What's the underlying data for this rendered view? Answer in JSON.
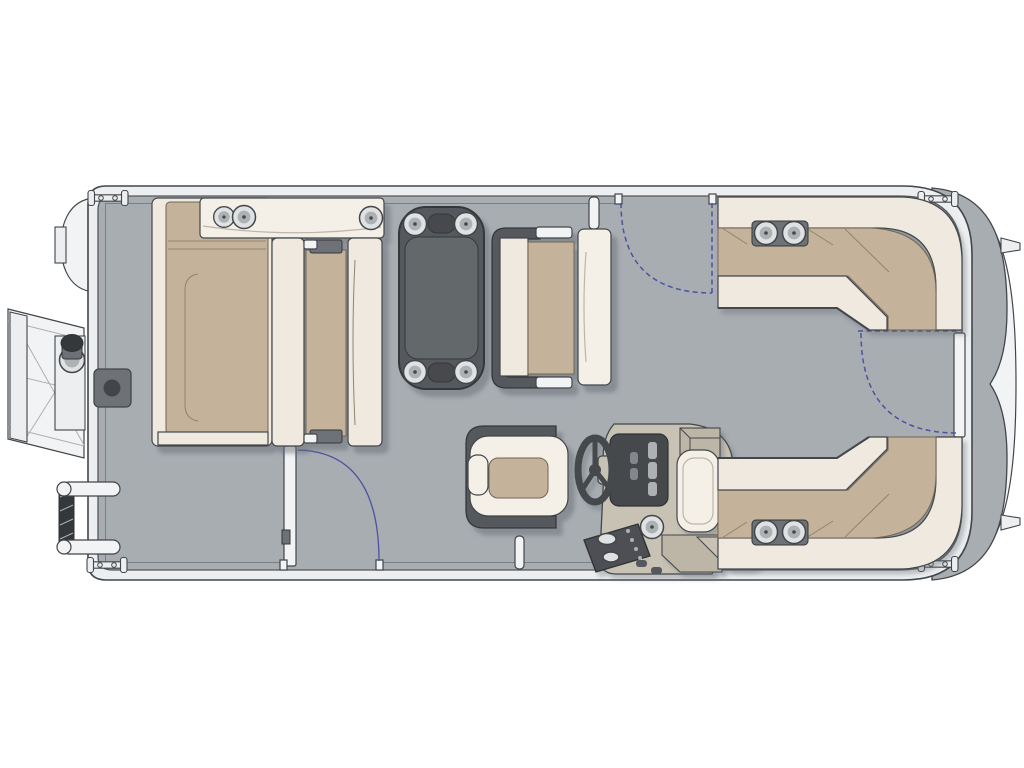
{
  "image": {
    "kind": "pontoon-boat-floorplan-top-view",
    "description": "Overhead 2D floor plan of a pontoon boat, bow ramp at left, rounded stern platform at right, no visible text labels",
    "visible_text": []
  },
  "palette": {
    "page": "#ffffff",
    "deck": "#a8adb2",
    "rail": "#eceeef",
    "line": "#42464a",
    "deckline": "#54585c",
    "deckline2": "#7c8085",
    "cream": "#efe9e0",
    "cream2": "#f4efe7",
    "tan": "#c4b39a",
    "tanline": "#6f6654",
    "seam": "#8f8470",
    "dark": "#55585c",
    "darkline": "#35383b",
    "tableInner": "#63676b",
    "slot": "#46494d",
    "console": "#c8c2b4",
    "console2": "#bdb6a7",
    "panel": "#45484c",
    "panelline": "#2f3235",
    "switch": "#4d5054",
    "metal": "#dfe1e3",
    "metal2": "#aeb1b4",
    "hinge": "#6e7276",
    "blue": "#4b53a2",
    "shadow": "#5d6570",
    "white": "#f2f3f4"
  },
  "components": {
    "exterior": [
      "boarding-gangway",
      "mooring-bollard",
      "motor-pod",
      "boarding-ladder",
      "stern-platform",
      "nose-trim",
      "tow-tabs",
      "cleats x4"
    ],
    "gates": [
      "port-gate with dashed swing arc",
      "starboard-gate with open door and arc",
      "stern-gate with dashed door line and arc"
    ],
    "furniture": [
      "port-bow-chaise-lounge",
      "armrest-console 3 cup holders",
      "back-to-back-bench",
      "pedestal-table 4 cup holders",
      "midship-bench",
      "captain-chair",
      "helm-console with steering wheel and switch panel",
      "aft-port-l-lounge 2 cup holders",
      "aft-starboard-l-lounge 2 cup holders",
      "helm-armrest"
    ]
  }
}
